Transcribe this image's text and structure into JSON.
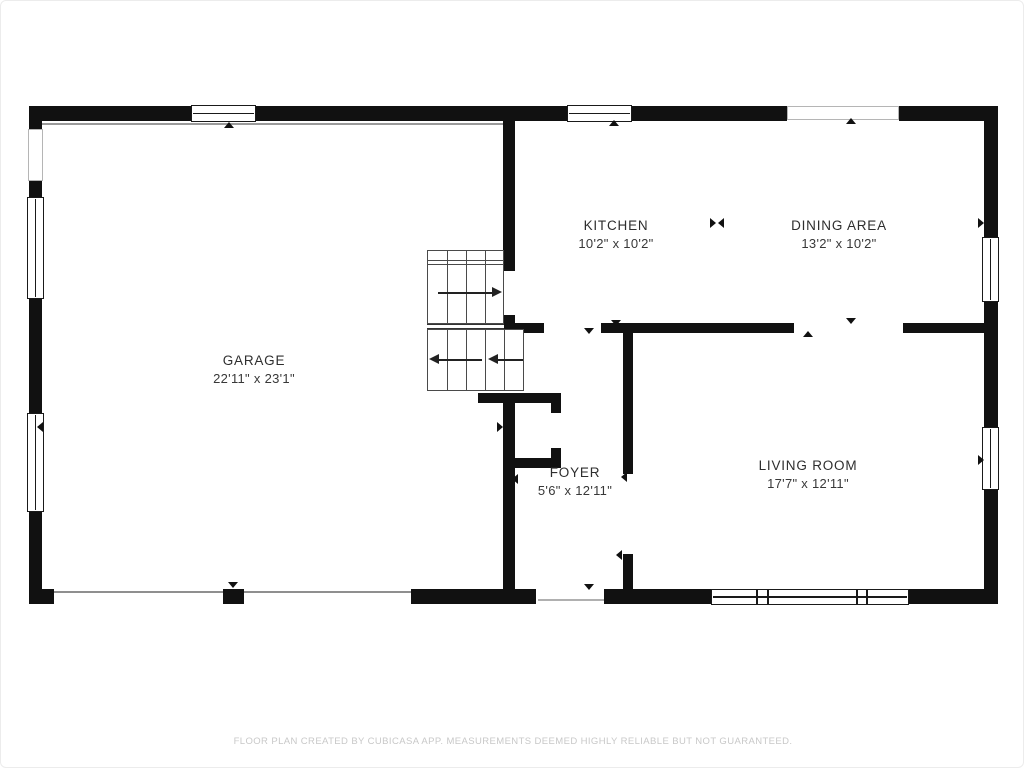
{
  "rooms": {
    "garage": {
      "name": "GARAGE",
      "dimensions": "22'11\" x 23'1\""
    },
    "kitchen": {
      "name": "KITCHEN",
      "dimensions": "10'2\" x 10'2\""
    },
    "dining_area": {
      "name": "DINING AREA",
      "dimensions": "13'2\" x 10'2\""
    },
    "living_room": {
      "name": "LIVING ROOM",
      "dimensions": "17'7\" x 12'11\""
    },
    "foyer": {
      "name": "FOYER",
      "dimensions": "5'6\" x 12'11\""
    }
  },
  "footer": {
    "disclaimer": "FLOOR PLAN CREATED BY CUBICASA APP. MEASUREMENTS DEEMED HIGHLY RELIABLE BUT NOT GUARANTEED."
  },
  "colors": {
    "wall": "#111111",
    "stair_line": "#4a4a4a",
    "label_text": "#2e2e2e",
    "footer_text": "#c8c8c8",
    "background": "#ffffff"
  }
}
